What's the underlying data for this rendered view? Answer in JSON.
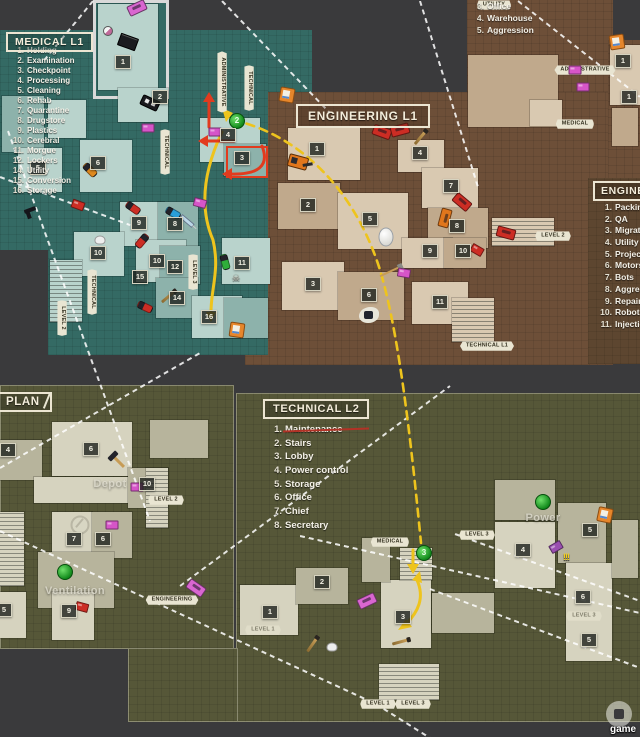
{
  "titles": {
    "medical": "MEDICAL L1",
    "engineering": "ENGINEERING L1",
    "technical": "TECHNICAL L2",
    "plan": "PLAN",
    "engineering_l2": "ENGINEERING L2"
  },
  "legends": {
    "medical": [
      {
        "num": "1.",
        "label": "Holding"
      },
      {
        "num": "2.",
        "label": "Examination"
      },
      {
        "num": "3.",
        "label": "Checkpoint"
      },
      {
        "num": "4.",
        "label": "Processing"
      },
      {
        "num": "5.",
        "label": "Cleaning"
      },
      {
        "num": "6.",
        "label": "Rehab"
      },
      {
        "num": "7.",
        "label": "Quarantine"
      },
      {
        "num": "8.",
        "label": "Drugstore"
      },
      {
        "num": "9.",
        "label": "Plastics"
      },
      {
        "num": "10.",
        "label": "Cerebral"
      },
      {
        "num": "11.",
        "label": "Morgue"
      },
      {
        "num": "12.",
        "label": "Lockers"
      },
      {
        "num": "14.",
        "label": "Utility"
      },
      {
        "num": "15.",
        "label": "Conversion"
      },
      {
        "num": "16.",
        "label": "Storage"
      }
    ],
    "technical": [
      {
        "num": "1.",
        "label": "Maintenance",
        "struck": true
      },
      {
        "num": "2.",
        "label": "Stairs"
      },
      {
        "num": "3.",
        "label": "Lobby"
      },
      {
        "num": "4.",
        "label": "Power control"
      },
      {
        "num": "5.",
        "label": "Storage"
      },
      {
        "num": "6.",
        "label": "Office"
      },
      {
        "num": "7.",
        "label": "Chief"
      },
      {
        "num": "8.",
        "label": "Secretary"
      }
    ],
    "engineering_corner": [
      {
        "num": "3.",
        "label": "Office"
      },
      {
        "num": "4.",
        "label": "Warehouse"
      },
      {
        "num": "5.",
        "label": "Aggression"
      }
    ],
    "engineering_l2": [
      {
        "num": "1.",
        "label": "Packing"
      },
      {
        "num": "2.",
        "label": "QA"
      },
      {
        "num": "3.",
        "label": "Migration"
      },
      {
        "num": "4.",
        "label": "Utility"
      },
      {
        "num": "5.",
        "label": "Projects"
      },
      {
        "num": "6.",
        "label": "Motors"
      },
      {
        "num": "7.",
        "label": "Bots"
      },
      {
        "num": "8.",
        "label": "Aggression"
      },
      {
        "num": "9.",
        "label": "Repairs"
      },
      {
        "num": "10.",
        "label": "Robots"
      },
      {
        "num": "11.",
        "label": "Injection"
      }
    ]
  },
  "area_labels": [
    {
      "text": "Depot",
      "x": 110,
      "y": 484
    },
    {
      "text": "Ventilation",
      "x": 75,
      "y": 591
    },
    {
      "text": "Power",
      "x": 543,
      "y": 518
    }
  ],
  "tags": [
    {
      "text": "UTILITY",
      "x": 494,
      "y": 5
    },
    {
      "text": "ADMINISTRATIVE",
      "x": 585,
      "y": 70
    },
    {
      "text": "MEDICAL",
      "x": 575,
      "y": 124
    },
    {
      "text": "LEVEL 2",
      "x": 553,
      "y": 236
    },
    {
      "text": "TECHNICAL L1",
      "x": 487,
      "y": 346
    },
    {
      "text": "LEVEL 2",
      "x": 166,
      "y": 500
    },
    {
      "text": "ENGINEERING",
      "x": 172,
      "y": 600
    },
    {
      "text": "MEDICAL",
      "x": 390,
      "y": 542
    },
    {
      "text": "LEVEL 3",
      "x": 477,
      "y": 535
    },
    {
      "text": "LEVEL 1",
      "x": 263,
      "y": 630,
      "faint": true
    },
    {
      "text": "LEVEL 1",
      "x": 378,
      "y": 704
    },
    {
      "text": "LEVEL 3",
      "x": 413,
      "y": 704
    },
    {
      "text": "LEVEL 3",
      "x": 584,
      "y": 616,
      "faint": true
    },
    {
      "text": "ADMINISTRATIVE",
      "x": 222,
      "y": 82,
      "vertical": true
    },
    {
      "text": "TECHNICAL",
      "x": 249,
      "y": 88,
      "vertical": true
    },
    {
      "text": "TECHNICAL",
      "x": 165,
      "y": 152,
      "vertical": true
    },
    {
      "text": "TECHNICAL",
      "x": 92,
      "y": 292,
      "vertical": true
    },
    {
      "text": "LEVEL 2",
      "x": 62,
      "y": 318,
      "vertical": true
    },
    {
      "text": "LEVEL 3",
      "x": 193,
      "y": 272,
      "vertical": true
    }
  ],
  "badges": [
    {
      "n": "1",
      "x": 123,
      "y": 62
    },
    {
      "n": "2",
      "x": 160,
      "y": 97
    },
    {
      "n": "3",
      "x": 242,
      "y": 158
    },
    {
      "n": "4",
      "x": 228,
      "y": 135
    },
    {
      "n": "5",
      "x": 38,
      "y": 168
    },
    {
      "n": "6",
      "x": 98,
      "y": 163
    },
    {
      "n": "8",
      "x": 175,
      "y": 224
    },
    {
      "n": "9",
      "x": 139,
      "y": 223
    },
    {
      "n": "10",
      "x": 98,
      "y": 253
    },
    {
      "n": "10",
      "x": 157,
      "y": 261
    },
    {
      "n": "11",
      "x": 242,
      "y": 263
    },
    {
      "n": "12",
      "x": 175,
      "y": 267
    },
    {
      "n": "14",
      "x": 177,
      "y": 298
    },
    {
      "n": "15",
      "x": 140,
      "y": 277
    },
    {
      "n": "16",
      "x": 209,
      "y": 317
    },
    {
      "n": "1",
      "x": 317,
      "y": 149
    },
    {
      "n": "2",
      "x": 308,
      "y": 205
    },
    {
      "n": "3",
      "x": 313,
      "y": 284
    },
    {
      "n": "4",
      "x": 420,
      "y": 153
    },
    {
      "n": "5",
      "x": 370,
      "y": 219
    },
    {
      "n": "6",
      "x": 369,
      "y": 295
    },
    {
      "n": "7",
      "x": 451,
      "y": 186
    },
    {
      "n": "8",
      "x": 457,
      "y": 226
    },
    {
      "n": "9",
      "x": 430,
      "y": 251
    },
    {
      "n": "10",
      "x": 463,
      "y": 251
    },
    {
      "n": "11",
      "x": 440,
      "y": 302
    },
    {
      "n": "1",
      "x": 623,
      "y": 61
    },
    {
      "n": "1",
      "x": 629,
      "y": 97
    },
    {
      "n": "4",
      "x": 8,
      "y": 450
    },
    {
      "n": "6",
      "x": 91,
      "y": 449
    },
    {
      "n": "10",
      "x": 147,
      "y": 484
    },
    {
      "n": "7",
      "x": 74,
      "y": 539
    },
    {
      "n": "6",
      "x": 103,
      "y": 539
    },
    {
      "n": "5",
      "x": 4,
      "y": 610
    },
    {
      "n": "9",
      "x": 69,
      "y": 611
    },
    {
      "n": "1",
      "x": 270,
      "y": 612
    },
    {
      "n": "2",
      "x": 322,
      "y": 582
    },
    {
      "n": "3",
      "x": 403,
      "y": 617
    },
    {
      "n": "4",
      "x": 523,
      "y": 550
    },
    {
      "n": "5",
      "x": 590,
      "y": 530
    },
    {
      "n": "6",
      "x": 583,
      "y": 597
    },
    {
      "n": "5",
      "x": 589,
      "y": 640
    }
  ],
  "markers": [
    {
      "type": "save",
      "x": 287,
      "y": 95,
      "rot": 10
    },
    {
      "type": "save",
      "x": 237,
      "y": 330,
      "rot": 8
    },
    {
      "type": "save",
      "x": 617,
      "y": 42,
      "rot": -8
    },
    {
      "type": "save",
      "x": 605,
      "y": 515,
      "rot": 12
    },
    {
      "type": "mine",
      "x": 237,
      "y": 121,
      "text": "2"
    },
    {
      "type": "mine",
      "x": 424,
      "y": 553,
      "text": "3"
    },
    {
      "type": "mine",
      "x": 65,
      "y": 572,
      "text": ""
    },
    {
      "type": "mine",
      "x": 543,
      "y": 502,
      "text": ""
    },
    {
      "type": "car",
      "x": 137,
      "y": 8,
      "rot": -25,
      "color": "#d966d0"
    },
    {
      "type": "car",
      "x": 196,
      "y": 588,
      "rot": 35,
      "color": "#d966d0"
    },
    {
      "type": "car",
      "x": 367,
      "y": 601,
      "rot": -25,
      "color": "#d966d0"
    },
    {
      "type": "car",
      "x": 382,
      "y": 132,
      "rot": 20,
      "color": "#cc2d24"
    },
    {
      "type": "car",
      "x": 400,
      "y": 130,
      "rot": -15,
      "color": "#cc2d24"
    },
    {
      "type": "car",
      "x": 462,
      "y": 202,
      "rot": 40,
      "color": "#cc2d24"
    },
    {
      "type": "car",
      "x": 506,
      "y": 233,
      "rot": 15,
      "color": "#cc2d24"
    },
    {
      "type": "car",
      "x": 445,
      "y": 218,
      "rot": 105,
      "color": "#e0761c"
    },
    {
      "type": "police",
      "x": 150,
      "y": 103,
      "rot": 25
    },
    {
      "type": "excavator",
      "x": 298,
      "y": 162,
      "rot": 15
    },
    {
      "type": "egg",
      "x": 386,
      "y": 237
    },
    {
      "type": "broom",
      "x": 389,
      "y": 272,
      "rot": 65
    },
    {
      "type": "splat",
      "x": 369,
      "y": 315
    },
    {
      "type": "blackbox",
      "x": 128,
      "y": 42,
      "rot": 20
    },
    {
      "type": "ball",
      "x": 108,
      "y": 31
    },
    {
      "type": "capsule",
      "x": 133,
      "y": 208,
      "rot": 35,
      "color": "#cc2d24"
    },
    {
      "type": "capsule",
      "x": 142,
      "y": 241,
      "rot": 130,
      "color": "#cc2d24"
    },
    {
      "type": "capsule",
      "x": 145,
      "y": 307,
      "rot": 25,
      "color": "#cc2d24"
    },
    {
      "type": "capsule",
      "x": 173,
      "y": 213,
      "rot": 30,
      "color": "#2a9fd8"
    },
    {
      "type": "capsule",
      "x": 225,
      "y": 262,
      "rot": 75,
      "color": "#2fae3a"
    },
    {
      "type": "capsule",
      "x": 90,
      "y": 170,
      "rot": 45,
      "color": "#e08a1e"
    },
    {
      "type": "stick",
      "x": 420,
      "y": 138,
      "rot": 40
    },
    {
      "type": "stick",
      "x": 168,
      "y": 297,
      "rot": 50
    },
    {
      "type": "stick",
      "x": 312,
      "y": 645,
      "rot": 35
    },
    {
      "type": "stick",
      "x": 400,
      "y": 642,
      "rot": 75
    },
    {
      "type": "hammer",
      "x": 119,
      "y": 462,
      "rot": -45
    },
    {
      "type": "fan",
      "x": 80,
      "y": 525
    },
    {
      "type": "pistol",
      "x": 30,
      "y": 210,
      "rot": -20
    },
    {
      "type": "skeleton",
      "x": 236,
      "y": 277
    },
    {
      "type": "cat",
      "x": 100,
      "y": 240
    },
    {
      "type": "cat",
      "x": 332,
      "y": 647
    },
    {
      "type": "syringe",
      "x": 187,
      "y": 221,
      "rot": 40
    },
    {
      "type": "box",
      "x": 200,
      "y": 203,
      "rot": 15,
      "color": "#d655c8"
    },
    {
      "type": "box",
      "x": 148,
      "y": 128,
      "color": "#d655c8"
    },
    {
      "type": "box",
      "x": 215,
      "y": 132,
      "color": "#d655c8"
    },
    {
      "type": "box",
      "x": 404,
      "y": 273,
      "rot": 10,
      "color": "#d655c8"
    },
    {
      "type": "box",
      "x": 575,
      "y": 70,
      "color": "#d655c8"
    },
    {
      "type": "box",
      "x": 583,
      "y": 87,
      "color": "#d655c8"
    },
    {
      "type": "box",
      "x": 137,
      "y": 487,
      "color": "#d655c8"
    },
    {
      "type": "box",
      "x": 112,
      "y": 525,
      "color": "#d655c8"
    },
    {
      "type": "box",
      "x": 78,
      "y": 205,
      "rot": 20,
      "color": "#cc2d24"
    },
    {
      "type": "box",
      "x": 82,
      "y": 607,
      "rot": 15,
      "color": "#cc2d24"
    },
    {
      "type": "box",
      "x": 477,
      "y": 250,
      "rot": 30,
      "color": "#cc2d24"
    },
    {
      "type": "box",
      "x": 556,
      "y": 547,
      "rot": -30,
      "color": "#9a4fb0"
    },
    {
      "type": "exclam",
      "x": 566,
      "y": 557,
      "text": "!!!"
    }
  ],
  "watermark": {
    "text": "game"
  },
  "colors": {
    "background": "#3a3a3c",
    "medical_teal": "#346a64",
    "engineering_brown": "#6d4f38",
    "technical_olive": "#565738",
    "route_yellow": "#eec41d",
    "route_red": "#e23b1e",
    "tag_bg": "#e9e5d2",
    "save_orange": "#e6862b",
    "mine_green": "#128a1c"
  }
}
